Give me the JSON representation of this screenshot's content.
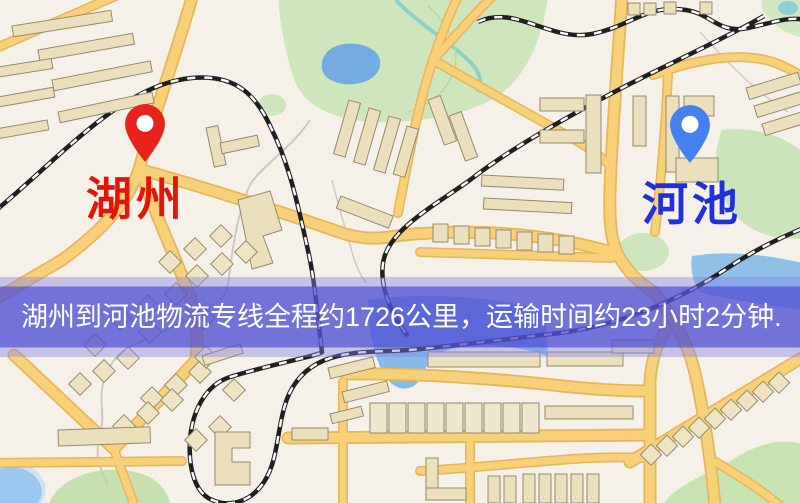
{
  "route_banner": {
    "text": "湖州到河池物流专线全程约1726公里，运输时间约23小时2分钟.",
    "text_color": "#ffffff",
    "overlay_color": "#5252d4"
  },
  "origin_marker": {
    "label": "湖州",
    "pin_color": "#e8231a",
    "label_color": "#e41408"
  },
  "destination_marker": {
    "label": "河池",
    "pin_color": "#4481ee",
    "label_color": "#2030dd"
  },
  "route": {
    "origin": "湖州",
    "destination": "河池",
    "distance_text": "约1726公里",
    "duration_text": "约23小时2分钟"
  },
  "map_palette": {
    "background": "#f6f1e8",
    "road_fill": "#f7d077",
    "road_casing": "#e7b55e",
    "building_fill": "#ebdfbc",
    "park_green": "#cfe6bd",
    "water_blue": "#7fb4e4",
    "railway_dark": "#1f1f1f"
  }
}
